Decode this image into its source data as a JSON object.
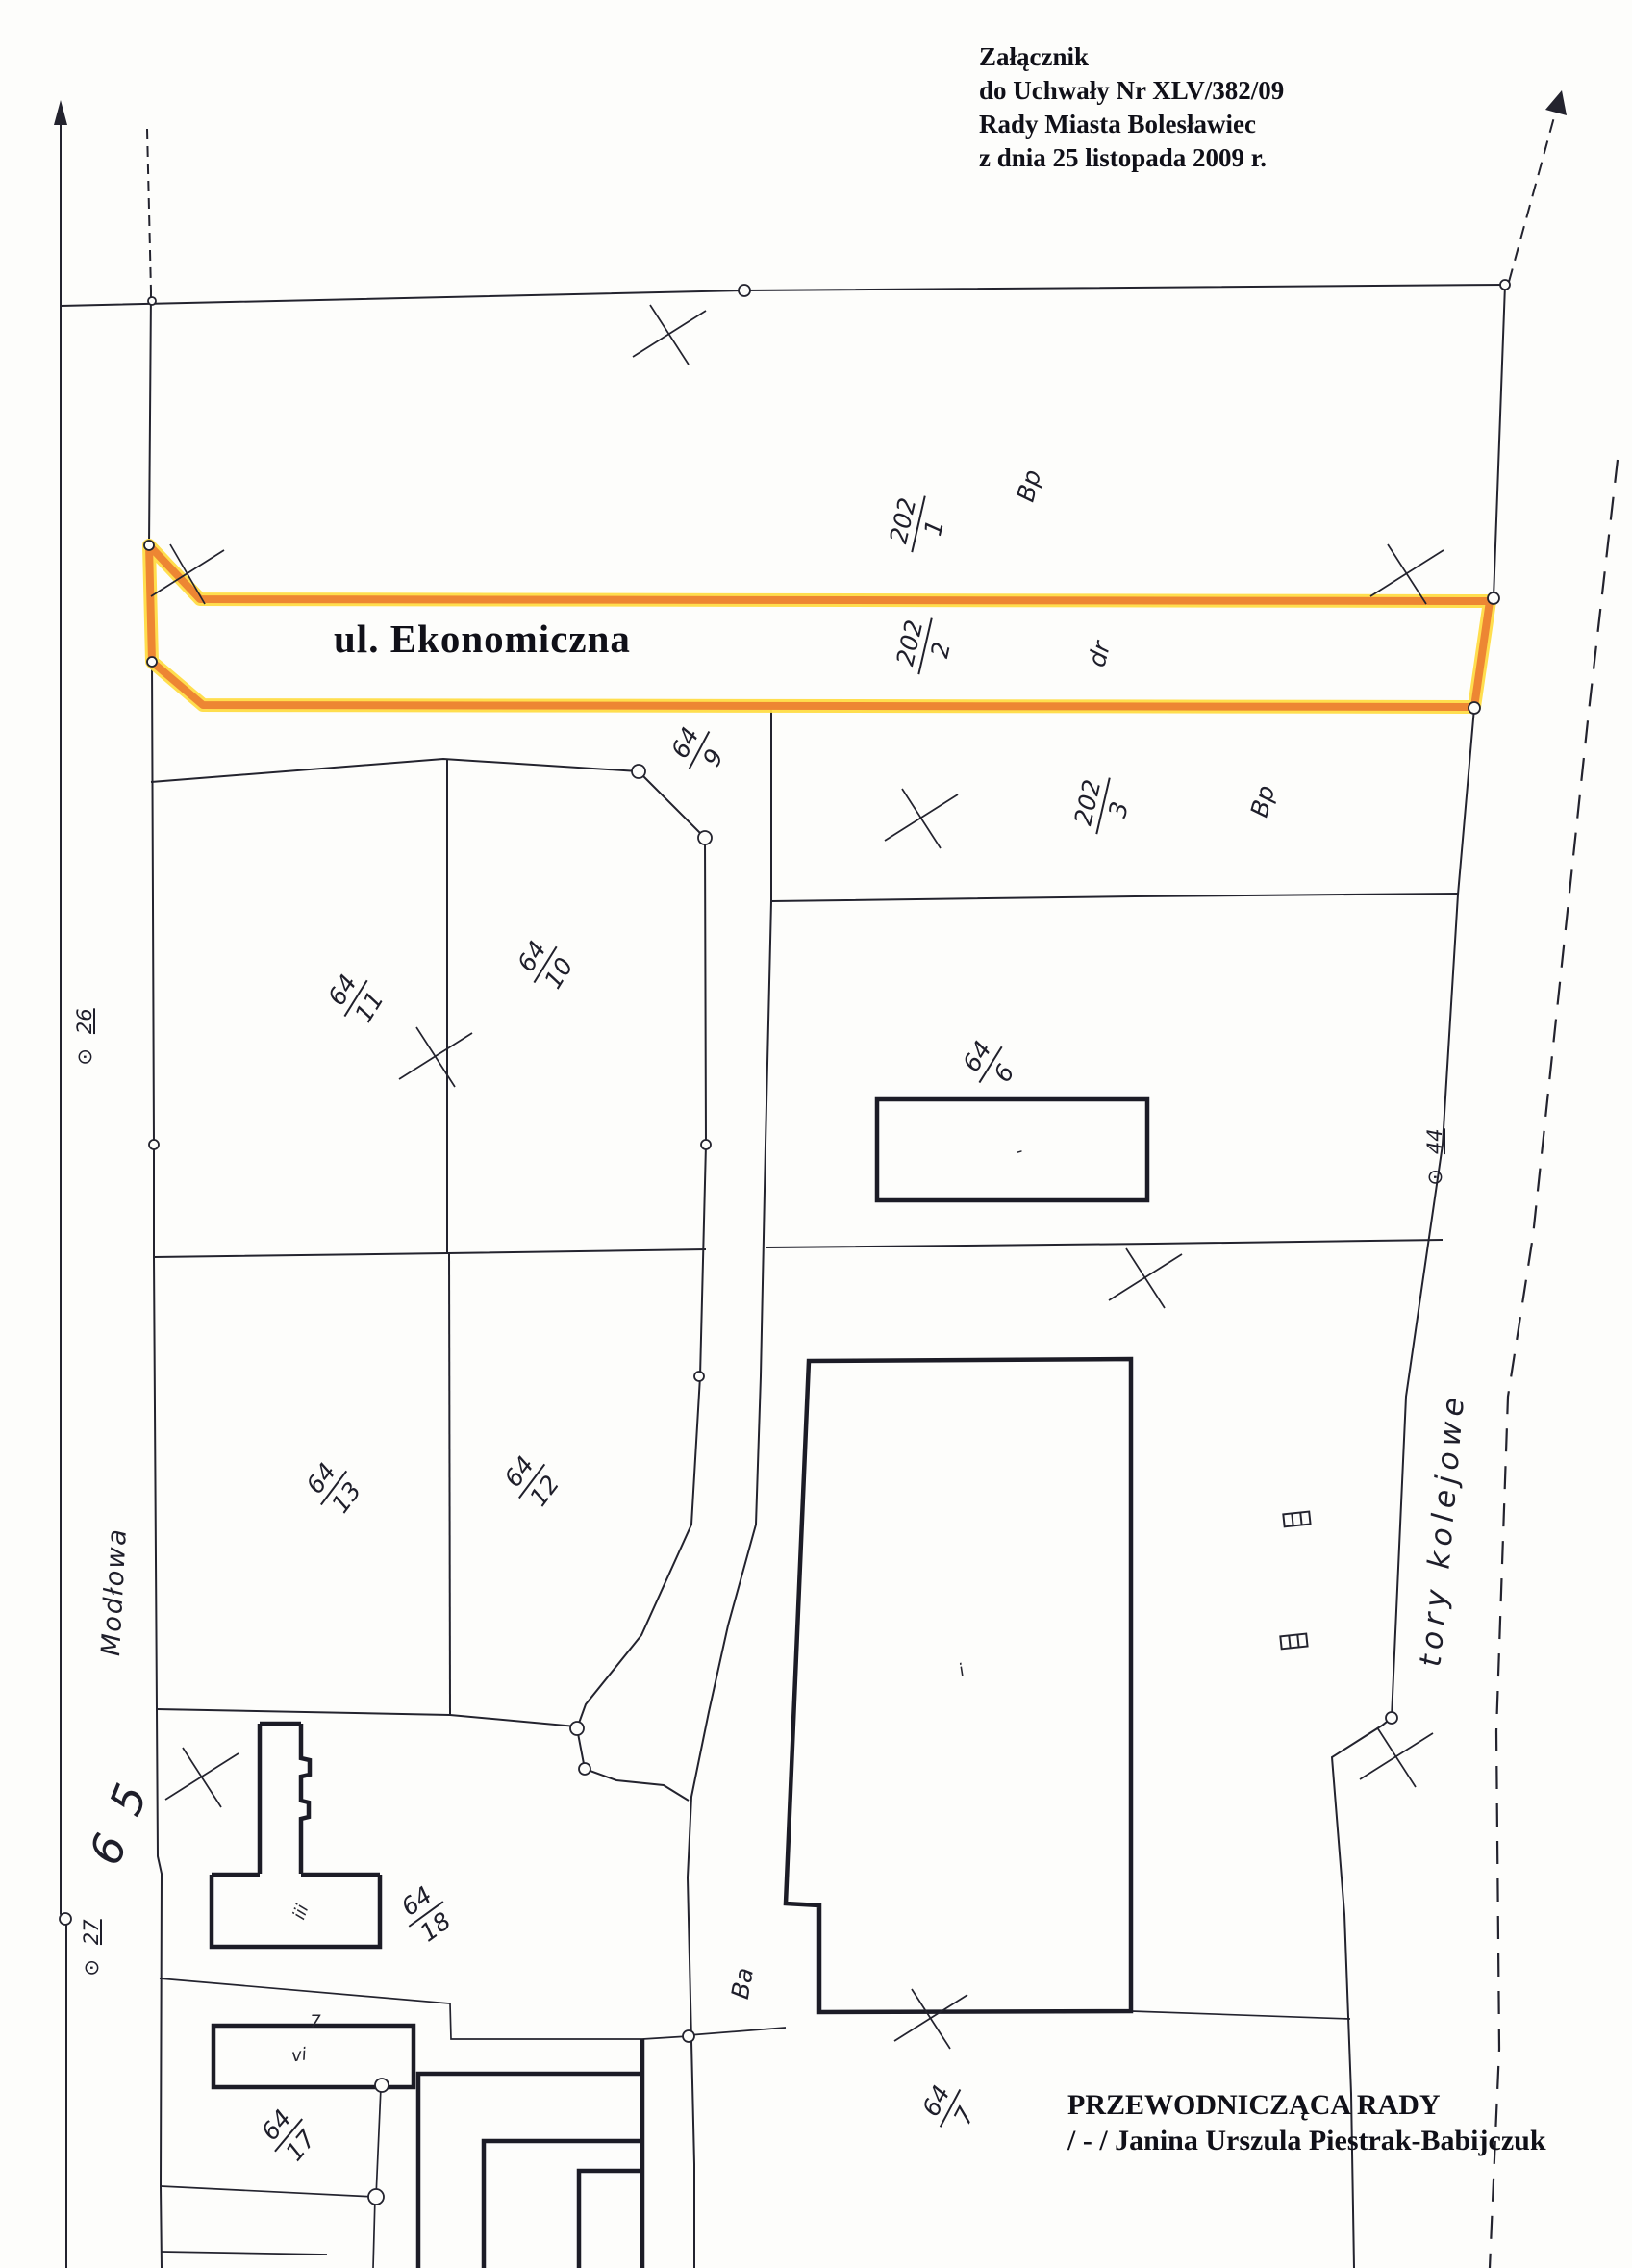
{
  "header": {
    "line1": "Załącznik",
    "line2": "do Uchwały Nr XLV/382/09",
    "line3": "Rady Miasta Bolesławiec",
    "line4": "z dnia 25 listopada 2009 r."
  },
  "highlight": {
    "street_name": "ul. Ekonomiczna",
    "color": "#ED8633",
    "glow_color": "#FFDC45"
  },
  "footer": {
    "role": "PRZEWODNICZĄCA RADY",
    "signature": "/ - / Janina Urszula Piestrak-Babijczuk"
  },
  "map": {
    "streets": {
      "west": "Modłowa",
      "railway": "tory kolejowe",
      "road_number": "6 5"
    },
    "survey": {
      "symbol": "⊙",
      "p26": "26",
      "p27": "27",
      "p44": "44"
    },
    "land_use": {
      "bp_north": "Bp",
      "dr": "dr",
      "bp_east": "Bp",
      "ba": "Ba"
    },
    "parcels": {
      "p202_1": {
        "num": "202",
        "den": "1"
      },
      "p202_2": {
        "num": "202",
        "den": "2"
      },
      "p202_3": {
        "num": "202",
        "den": "3"
      },
      "p64_9": {
        "num": "64",
        "den": "9"
      },
      "p64_10": {
        "num": "64",
        "den": "10"
      },
      "p64_11": {
        "num": "64",
        "den": "11"
      },
      "p64_6": {
        "num": "64",
        "den": "6"
      },
      "p64_13": {
        "num": "64",
        "den": "13"
      },
      "p64_12": {
        "num": "64",
        "den": "12"
      },
      "p64_18": {
        "num": "64",
        "den": "18"
      },
      "p64_17": {
        "num": "64",
        "den": "17"
      },
      "p64_7": {
        "num": "64",
        "den": "7"
      }
    },
    "building_marks": {
      "t_building": "iii",
      "garage": "vi",
      "roof_note": "7",
      "hall": "i",
      "store": "-"
    }
  }
}
